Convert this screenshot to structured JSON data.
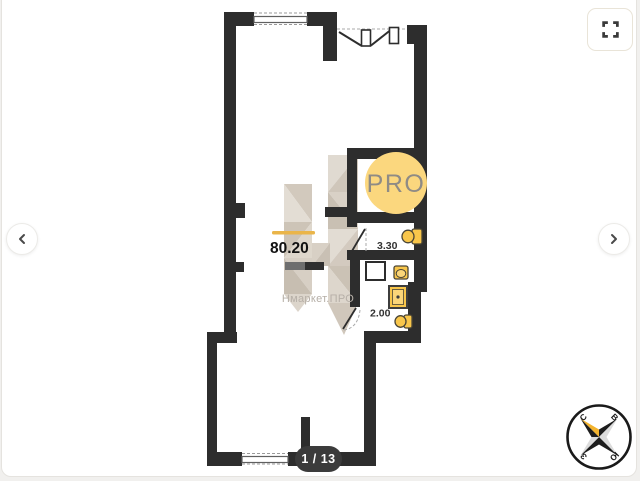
{
  "viewer": {
    "counter": "1 / 13"
  },
  "plan": {
    "area": "80.20",
    "brand": "Нмаркет.ПРО",
    "badge": "PRO",
    "labels": {
      "room_330": "3.30",
      "room_200": "2.00"
    },
    "compass": {
      "n": "С",
      "e": "В",
      "s": "Ю",
      "w": "З"
    }
  },
  "colors": {
    "wall": "#2d2d2d",
    "badge_bg": "#fbd77e",
    "badge_text": "#8f8b85",
    "fixture_yellow": "#f8c64b",
    "accent_gold": "#eab549",
    "watermark_beige": "#d8d0c5",
    "brand_text": "#b6afa7",
    "counter_bg": "#3b3b3b",
    "compass_north": "#f3b32d",
    "card_border": "#e5e3df"
  }
}
